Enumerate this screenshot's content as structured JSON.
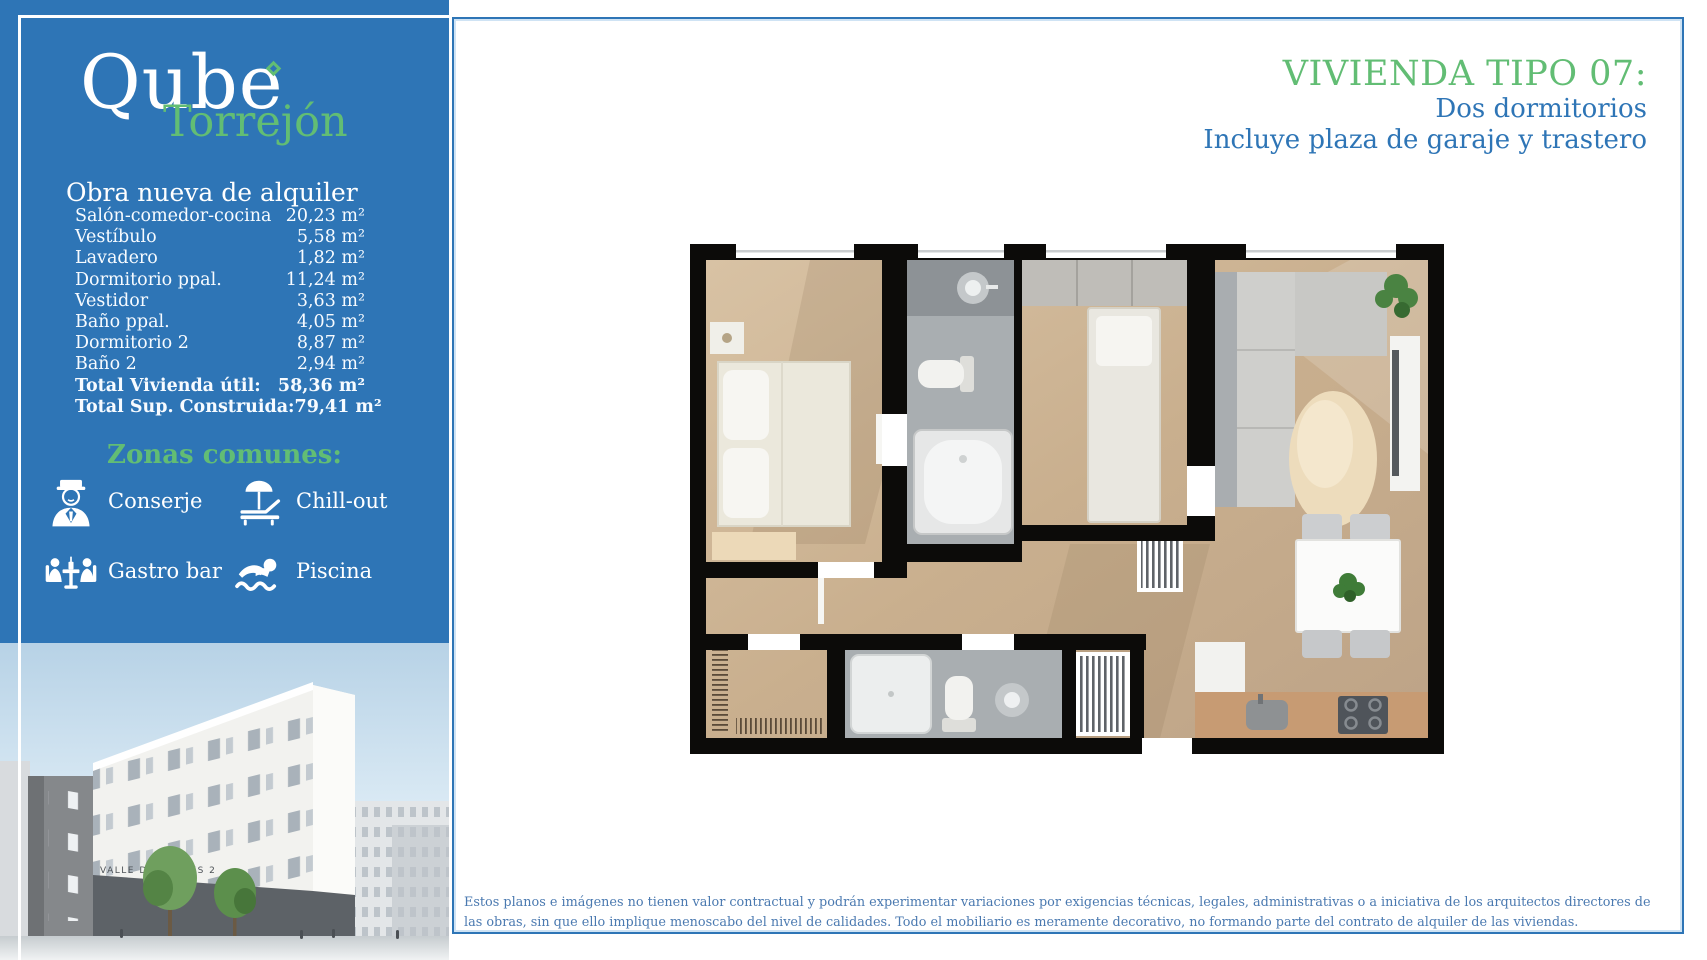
{
  "brand": {
    "name": "Qube",
    "location": "Torrejón",
    "tagline": "Obra nueva de alquiler"
  },
  "areas": {
    "rows": [
      {
        "label": "Salón-comedor-cocina",
        "value": "20,23 m²"
      },
      {
        "label": "Vestíbulo",
        "value": "5,58 m²"
      },
      {
        "label": "Lavadero",
        "value": "1,82 m²"
      },
      {
        "label": "Dormitorio ppal.",
        "value": "11,24 m²"
      },
      {
        "label": "Vestidor",
        "value": "3,63 m²"
      },
      {
        "label": "Baño ppal.",
        "value": "4,05 m²"
      },
      {
        "label": "Dormitorio 2",
        "value": "8,87 m²"
      },
      {
        "label": "Baño 2",
        "value": "2,94 m²"
      },
      {
        "label": "Total Vivienda útil:",
        "value": "58,36 m²"
      },
      {
        "label": "Total Sup. Construida:",
        "value": "79,41 m²"
      }
    ]
  },
  "zones": {
    "title": "Zonas comunes:",
    "items": [
      {
        "icon": "concierge-icon",
        "label": "Conserje"
      },
      {
        "icon": "sunlounger-icon",
        "label": "Chill-out"
      },
      {
        "icon": "gastrobar-icon",
        "label": "Gastro bar"
      },
      {
        "icon": "swimmer-icon",
        "label": "Piscina"
      }
    ]
  },
  "building": {
    "sign": "VALLE DE AMBLES 2"
  },
  "header": {
    "title": "VIVIENDA TIPO 07:",
    "subtitle_1": "Dos dormitorios",
    "subtitle_2": "Incluye plaza de garaje y trastero"
  },
  "footer": {
    "disclaimer": "Estos planos e imágenes no tienen valor contractual y podrán experimentar variaciones por exigencias técnicas, legales, administrativas o a iniciativa de los arquitectos directores de las obras, sin que ello implique menoscabo del nivel de calidades. Todo el mobiliario es meramente decorativo, no formando parte del contrato de alquiler de las viviendas."
  },
  "colors": {
    "primary_blue": "#2e75b6",
    "accent_green": "#62bd74",
    "disclaimer_blue": "#4a79b0"
  }
}
